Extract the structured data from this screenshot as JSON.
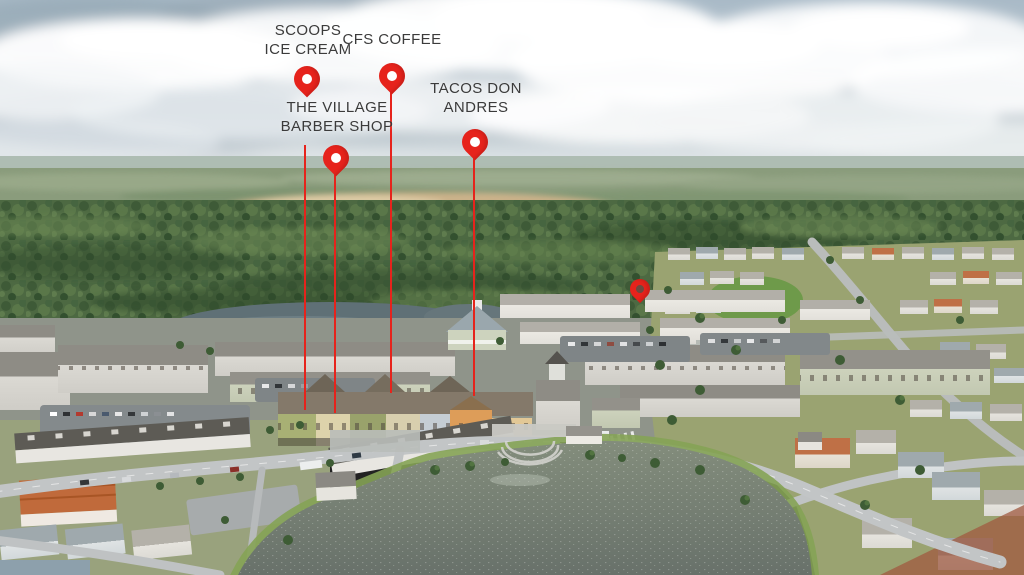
{
  "scene": {
    "type": "aerial-photo",
    "description": "Aerial drone view of a lakeside town-center community surrounded by forest, with businesses marked by red map pins"
  },
  "markers": {
    "scoops": {
      "line1": "SCOOPS",
      "line2": "ICE CREAM"
    },
    "cfs": {
      "line1": "CFS COFFEE",
      "line2": ""
    },
    "village": {
      "line1": "THE VILLAGE",
      "line2": "BARBER SHOP"
    },
    "tacos": {
      "line1": "TACOS DON",
      "line2": "ANDRES"
    }
  },
  "colors": {
    "pin": "#e6231c",
    "label_text": "#3b3b3b"
  }
}
